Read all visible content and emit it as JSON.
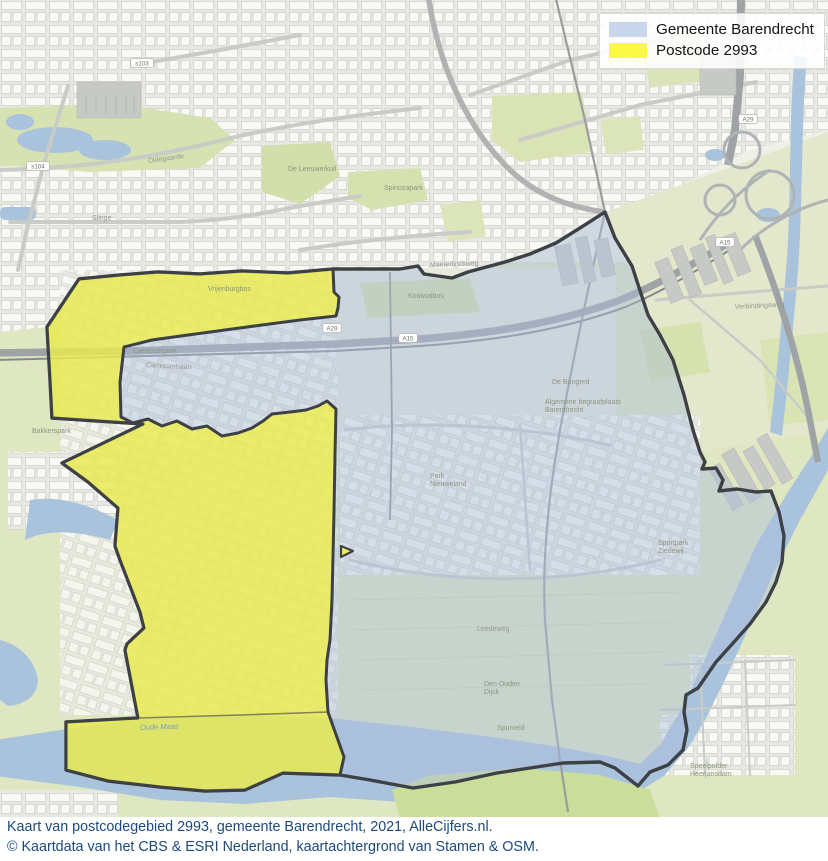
{
  "legend": {
    "items": [
      {
        "label": "Gemeente Barendrecht",
        "swatch": "#c9d5ea"
      },
      {
        "label": "Postcode 2993",
        "swatch": "#fafa45"
      }
    ]
  },
  "footer": {
    "line1": "Kaart van postcodegebied 2993, gemeente Barendrecht, 2021, AlleCijfers.nl.",
    "line2": "© Kaartdata van het CBS & ESRI Nederland, kaartachtergrond van Stamen & OSM."
  },
  "map": {
    "region_fills": {
      "municipality": "rgba(170,188,219,0.45)",
      "postcode": "rgba(243,241,60,0.72)",
      "boundary": "#3d4145",
      "water": "#a9c3dd"
    },
    "labels": [
      {
        "text": "Maeterlinckweg",
        "x": 430,
        "y": 267,
        "cls": "road",
        "rot": -2
      },
      {
        "text": "Oldegaarde",
        "x": 148,
        "y": 163,
        "cls": "road",
        "rot": -8
      },
      {
        "text": "Slinge",
        "x": 92,
        "y": 220,
        "cls": "road"
      },
      {
        "text": "Carnisserpark",
        "x": 133,
        "y": 353,
        "cls": "area"
      },
      {
        "text": "Carnisserbaan",
        "x": 146,
        "y": 367,
        "cls": "road",
        "rot": 3
      },
      {
        "text": "Vrijenburgbos",
        "x": 208,
        "y": 291,
        "cls": "area"
      },
      {
        "text": "Kooiwalbos",
        "x": 408,
        "y": 298,
        "cls": "area"
      },
      {
        "text": "De Leeuwerkuil",
        "x": 288,
        "y": 171,
        "cls": "area"
      },
      {
        "text": "Spinozapark",
        "x": 384,
        "y": 190,
        "cls": "area"
      },
      {
        "text": "De Bongerd",
        "x": 552,
        "y": 384,
        "cls": "area"
      },
      {
        "text": "Algemene begraafplaats",
        "x": 545,
        "y": 404,
        "cls": "area"
      },
      {
        "text": "Barendrecht",
        "x": 545,
        "y": 412,
        "cls": "area"
      },
      {
        "text": "Park",
        "x": 430,
        "y": 478,
        "cls": "area"
      },
      {
        "text": "Nieuweland",
        "x": 430,
        "y": 486,
        "cls": "area"
      },
      {
        "text": "Sportpark",
        "x": 658,
        "y": 545,
        "cls": "area"
      },
      {
        "text": "Ziedewij",
        "x": 658,
        "y": 553,
        "cls": "area"
      },
      {
        "text": "Verbindingsweg",
        "x": 735,
        "y": 309,
        "cls": "road",
        "rot": -3
      },
      {
        "text": "Leedeweg",
        "x": 477,
        "y": 631,
        "cls": "road"
      },
      {
        "text": "Den Ouden",
        "x": 484,
        "y": 686,
        "cls": "area"
      },
      {
        "text": "Dijck",
        "x": 484,
        "y": 694,
        "cls": "area"
      },
      {
        "text": "Spurveld",
        "x": 497,
        "y": 730,
        "cls": "area"
      },
      {
        "text": "Speelpolder",
        "x": 690,
        "y": 768,
        "cls": "area"
      },
      {
        "text": "Heerjansdam",
        "x": 690,
        "y": 776,
        "cls": "area"
      },
      {
        "text": "Bakkerspark",
        "x": 32,
        "y": 433,
        "cls": "area"
      },
      {
        "text": "Oude Maas",
        "x": 140,
        "y": 730,
        "cls": "water",
        "rot": -2
      }
    ],
    "shields": [
      {
        "text": "A15",
        "x": 408,
        "y": 339
      },
      {
        "text": "A15",
        "x": 725,
        "y": 243
      },
      {
        "text": "A29",
        "x": 332,
        "y": 329
      },
      {
        "text": "A29",
        "x": 748,
        "y": 120
      },
      {
        "text": "s103",
        "x": 142,
        "y": 64
      },
      {
        "text": "s104",
        "x": 38,
        "y": 167
      }
    ]
  }
}
